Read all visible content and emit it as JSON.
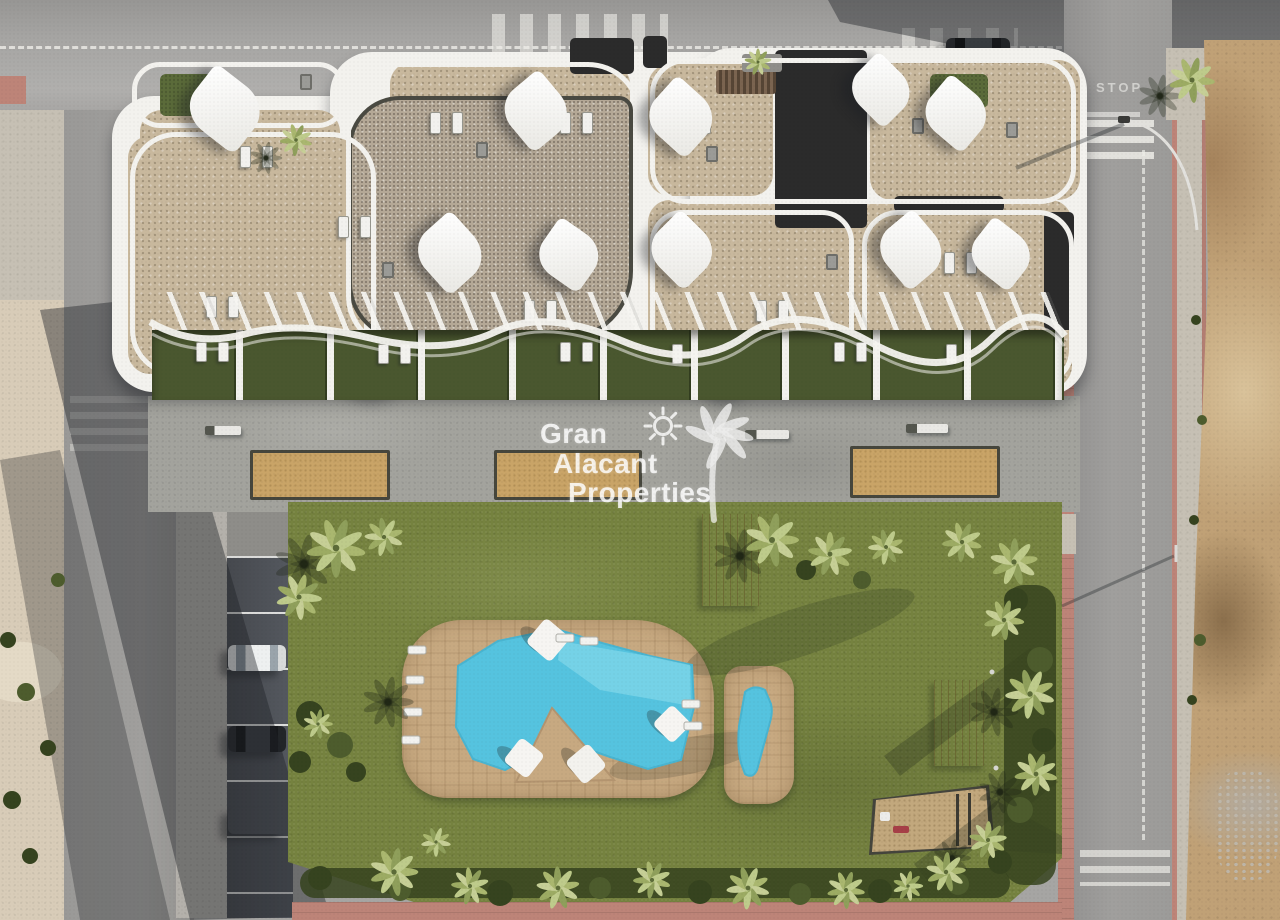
{
  "meta": {
    "width": 1280,
    "height": 920,
    "view": "top-down aerial 3D render of apartment complex"
  },
  "watermark": {
    "line1": "Gran",
    "line2": "Alacant",
    "line3": "Properties"
  },
  "road_markings": {
    "stop_text": "STOP"
  },
  "inventory": {
    "shade_sails": 10,
    "petanque_courts": 3,
    "private_garden_terraces": 10,
    "pools": 2,
    "parked_cars_parking_row": 3,
    "parked_car_street": 1,
    "cars_on_road": 1,
    "motorcycles": 1,
    "wooden_lounger_groups": 2,
    "playground_areas": 1
  },
  "colors": {
    "asphalt": "#a6a5a3",
    "asphalt2": "#a09f9d",
    "sidewalk": "#c6c0b4",
    "pink": "#bd8478",
    "sandside": "#d8ccb8",
    "dirt": "#c0a176",
    "lawn": "#75823f",
    "hedge": "#36431f",
    "water": "#55c3df",
    "water2": "#8adcec",
    "deck": "#c7a981",
    "beige": "#c8b89d",
    "gravel": "#b4a896",
    "dark": "#2b2b2b",
    "white": "#f3f2ee",
    "plaza": "#a3a39d",
    "sandcourt": "#c9a467",
    "garden": "#4a572f",
    "shadow": "rgba(30,33,38,0.42)",
    "wood": "#c49e6f",
    "wm": "rgba(255,255,255,0.82)"
  }
}
